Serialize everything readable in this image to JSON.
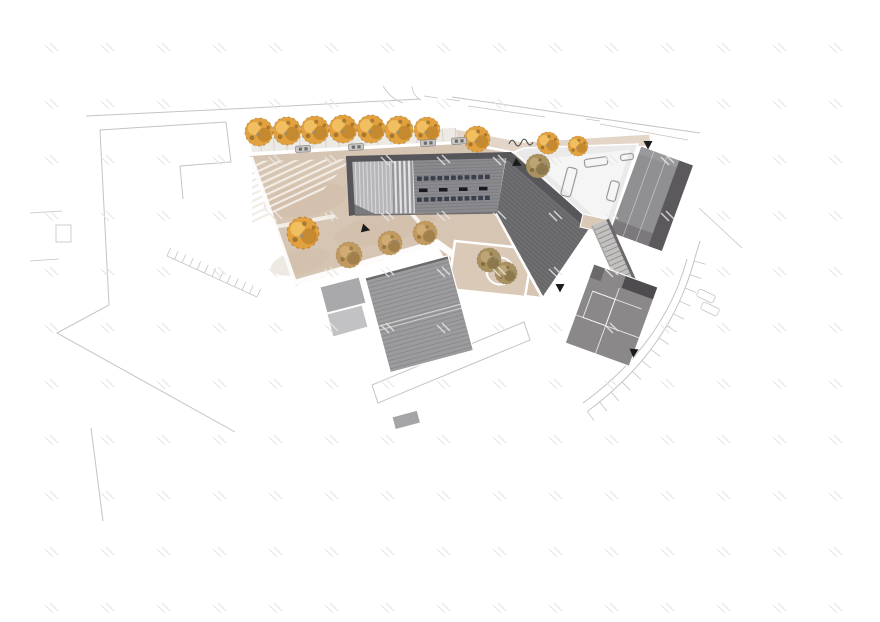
{
  "document": {
    "kind": "architectural-site-plan",
    "view": "aerial roof plan with context line work, no visible text labels"
  },
  "colors": {
    "paper": "#ffffff",
    "context_line": "#c6c3c0",
    "plaza": "#d7c5b3",
    "plaza_shade": "#c9b49e",
    "plaza_path": "#f2ece5",
    "sidewalk": "#edeae6",
    "sidewalk_joint": "#d6d1cb",
    "road_strip": "#e3d5c7",
    "roof_main": "#8b8a8e",
    "roof_rib": "#7d7c80",
    "roof_dark_band": "#57565a",
    "roof_light": "#b6b5b7",
    "roof_light_rib": "#dcdbdd",
    "louver_light": "#e4e4e6",
    "louver_dark": "#97969a",
    "wing": "#6f6e71",
    "wing_rib": "#626165",
    "skylight": "#3a3f4b",
    "skylight_dark": "#17191e",
    "courtyard": "#eaeaeb",
    "courtyard_inner": "#f5f5f6",
    "bench_stroke": "#9b9a9a",
    "roof_right": "#908f91",
    "roof_right_dark": "#5b595c",
    "roof_right_bottom": "#7b797b",
    "roof_low": "#8b8889",
    "roof_low_dark": "#4e4c4e",
    "roof_low_patch": "#6b696b",
    "roof_big": "#9c9b9d",
    "roof_big_rib": "#8b8a8c",
    "roof_big_edge": "#6a696b",
    "annex": "#a9a8aa",
    "annex_light": "#c2c1c3",
    "stairs": "#c3c1bf",
    "stair_line": "#8f8d8b",
    "patio": "#dbc9b8",
    "tree_orange": "#e2a13e",
    "tree_orange_light": "#f3c466",
    "tree_orange_dark": "#b97f2a",
    "tree_speckle": "#6f5526",
    "tree_tan": "#c09a5e",
    "tree_tan_dark": "#8d6f3f",
    "tree_brown": "#a8915f",
    "tree_brown_dark": "#77643e",
    "marker": "#1c1c1c",
    "car_body": "#c9c7c5",
    "car_dark": "#6e6c6a",
    "fence_line": "#4c4b4a",
    "watermark": "#e9e7e4"
  },
  "plan": {
    "trees": [
      {
        "x": 259,
        "y": 132,
        "r": 14,
        "type": "orange"
      },
      {
        "x": 287,
        "y": 131,
        "r": 14,
        "type": "orange"
      },
      {
        "x": 315,
        "y": 130,
        "r": 14,
        "type": "orange"
      },
      {
        "x": 343,
        "y": 129,
        "r": 14,
        "type": "orange"
      },
      {
        "x": 371,
        "y": 129,
        "r": 14,
        "type": "orange"
      },
      {
        "x": 399,
        "y": 130,
        "r": 14,
        "type": "orange"
      },
      {
        "x": 427,
        "y": 130,
        "r": 13,
        "type": "orange"
      },
      {
        "x": 477,
        "y": 139,
        "r": 13,
        "type": "orange"
      },
      {
        "x": 548,
        "y": 143,
        "r": 11,
        "type": "orange"
      },
      {
        "x": 578,
        "y": 146,
        "r": 10,
        "type": "orange"
      },
      {
        "x": 538,
        "y": 166,
        "r": 12,
        "type": "brown"
      },
      {
        "x": 303,
        "y": 233,
        "r": 16,
        "type": "orange"
      },
      {
        "x": 349,
        "y": 255,
        "r": 13,
        "type": "tan"
      },
      {
        "x": 390,
        "y": 243,
        "r": 12,
        "type": "tan"
      },
      {
        "x": 425,
        "y": 233,
        "r": 12,
        "type": "tan"
      },
      {
        "x": 489,
        "y": 260,
        "r": 12,
        "type": "brown"
      },
      {
        "x": 506,
        "y": 273,
        "r": 11,
        "type": "brown"
      }
    ],
    "cars": [
      {
        "x": 303,
        "y": 149,
        "a": -3
      },
      {
        "x": 356,
        "y": 147,
        "a": -3
      },
      {
        "x": 428,
        "y": 143,
        "a": -3
      },
      {
        "x": 459,
        "y": 141,
        "a": -3
      }
    ],
    "markers": [
      {
        "x": 362,
        "y": 228,
        "a": 15
      },
      {
        "x": 514,
        "y": 162,
        "a": 25
      },
      {
        "x": 648,
        "y": 141,
        "a": 90
      },
      {
        "x": 560,
        "y": 284,
        "a": 90
      },
      {
        "x": 634,
        "y": 349,
        "a": 95
      }
    ],
    "benches": [
      {
        "x": 569,
        "y": 182,
        "w": 10,
        "h": 29,
        "a": 15
      },
      {
        "x": 596,
        "y": 162,
        "w": 23,
        "h": 8,
        "a": -8
      },
      {
        "x": 613,
        "y": 191,
        "w": 9,
        "h": 20,
        "a": 15
      },
      {
        "x": 627,
        "y": 157,
        "w": 13,
        "h": 6,
        "a": -8
      }
    ],
    "skylight_rows": [
      {
        "x0": 417,
        "y0": 176.5,
        "n": 11,
        "dx": 6.8,
        "w": 4.8,
        "h": 4.4,
        "slope": -0.028,
        "tone": "skylight"
      },
      {
        "x0": 419,
        "y0": 188.5,
        "n": 4,
        "dx": 20,
        "w": 8.5,
        "h": 3.6,
        "slope": -0.028,
        "tone": "skylight_dark"
      },
      {
        "x0": 417,
        "y0": 197.5,
        "n": 11,
        "dx": 6.8,
        "w": 4.8,
        "h": 4.4,
        "slope": -0.028,
        "tone": "skylight"
      }
    ],
    "ramp": {
      "x0": 238,
      "y0": 167,
      "dy": 6.8,
      "n": 10,
      "dx": 116,
      "drop": 54
    },
    "stairs": {
      "x": 592,
      "y": 226,
      "angle": -24,
      "w": 17,
      "len": 68,
      "treads": 14
    },
    "stall_row": {
      "x1": 167,
      "y1": 256,
      "x2": 257,
      "y2": 297,
      "n": 12,
      "len": 9
    },
    "parking_arc": {
      "p0": [
        694,
        261
      ],
      "p1": [
        669,
        351
      ],
      "p2": [
        587,
        411
      ],
      "n": 13,
      "len": 12
    },
    "watermark": {
      "x0": 45,
      "y0": 45,
      "dx": 56,
      "dy": 56,
      "cols": 15,
      "rows": 11
    }
  }
}
